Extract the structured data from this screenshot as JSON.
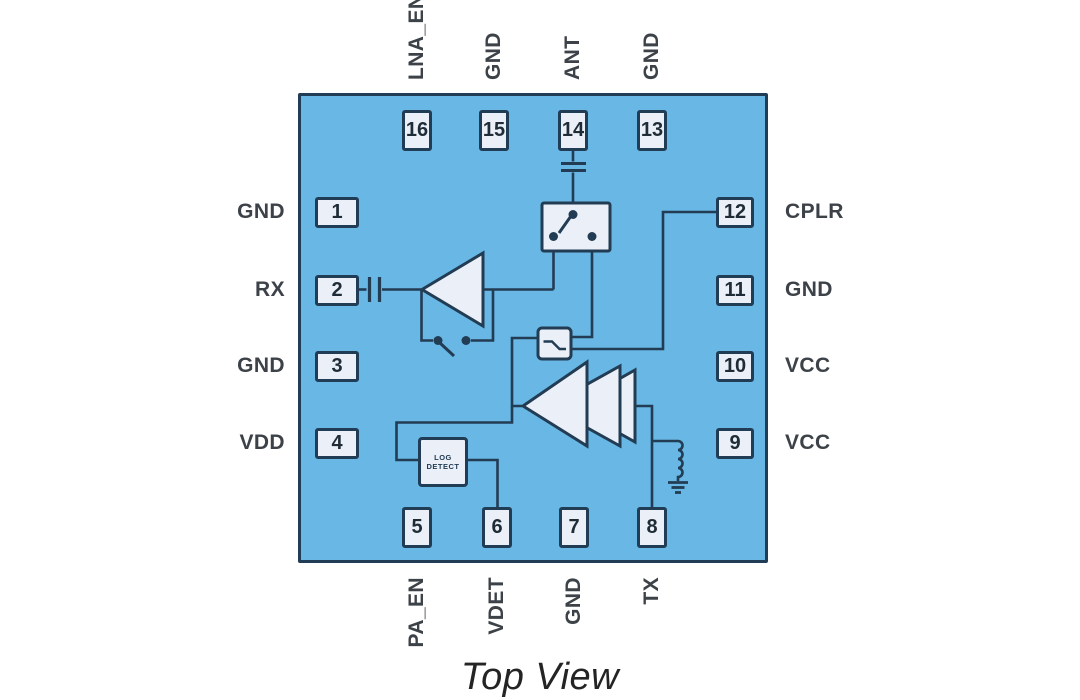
{
  "title": "Top View",
  "colors": {
    "chip_fill": "#68b7e5",
    "outline": "#213c55",
    "component_fill": "#ebf0f8",
    "label_text": "#3c4248"
  },
  "pins": {
    "top": [
      {
        "number": "16",
        "label": "LNA_EN"
      },
      {
        "number": "15",
        "label": "GND"
      },
      {
        "number": "14",
        "label": "ANT"
      },
      {
        "number": "13",
        "label": "GND"
      }
    ],
    "left": [
      {
        "number": "1",
        "label": "GND"
      },
      {
        "number": "2",
        "label": "RX"
      },
      {
        "number": "3",
        "label": "GND"
      },
      {
        "number": "4",
        "label": "VDD"
      }
    ],
    "right": [
      {
        "number": "12",
        "label": "CPLR"
      },
      {
        "number": "11",
        "label": "GND"
      },
      {
        "number": "10",
        "label": "VCC"
      },
      {
        "number": "9",
        "label": "VCC"
      }
    ],
    "bottom": [
      {
        "number": "5",
        "label": "PA_EN"
      },
      {
        "number": "6",
        "label": "VDET"
      },
      {
        "number": "7",
        "label": "GND"
      },
      {
        "number": "8",
        "label": "TX"
      }
    ]
  },
  "blocks": {
    "log_detect": {
      "line1": "LOG",
      "line2": "DETECT"
    }
  },
  "components": [
    "rx-dc-block-capacitor",
    "lna-amplifier",
    "lna-bypass-switch",
    "ant-series-capacitor",
    "spdt-antenna-switch",
    "directional-coupler",
    "pa-amplifier-3-stage",
    "rf-choke-inductor",
    "ground-symbol",
    "log-detector"
  ]
}
